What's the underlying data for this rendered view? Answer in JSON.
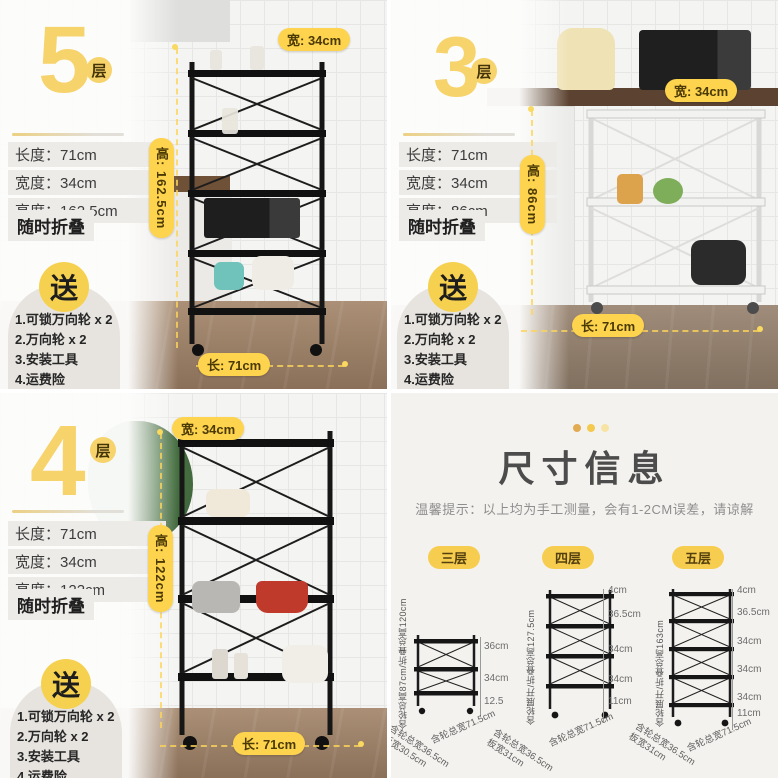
{
  "ui": {
    "colon": "：",
    "accent_yellow": "#f6d36b",
    "badge_yellow": "#fed44f",
    "tab_yellow": "#f6cd4e",
    "dot_colors": [
      "#e2ab52",
      "#f3c94e",
      "#f7e3a4"
    ],
    "panel_bg": "#f4f2ef",
    "text_dark": "#3c3c3c"
  },
  "panels": [
    {
      "tier_number": "5",
      "tier_unit": "层",
      "specs": [
        {
          "label": "长度",
          "value": "71cm"
        },
        {
          "label": "宽度",
          "value": "34cm"
        },
        {
          "label": "高度",
          "value": "162.5cm"
        }
      ],
      "fold_note": "随时折叠",
      "gift_badge": "送",
      "gifts": [
        "1.可锁万向轮 x 2",
        "2.万向轮 x 2",
        "3.安装工具",
        "4.运费险"
      ],
      "width_badge": "宽: 34cm",
      "height_badge": "高: 162.5cm",
      "length_badge": "长: 71cm"
    },
    {
      "tier_number": "3",
      "tier_unit": "层",
      "specs": [
        {
          "label": "长度",
          "value": "71cm"
        },
        {
          "label": "宽度",
          "value": "34cm"
        },
        {
          "label": "高度",
          "value": "86cm"
        }
      ],
      "fold_note": "随时折叠",
      "gift_badge": "送",
      "gifts": [
        "1.可锁万向轮 x 2",
        "2.万向轮 x 2",
        "3.安装工具",
        "4.运费险"
      ],
      "width_badge": "宽: 34cm",
      "height_badge": "高: 86cm",
      "length_badge": "长: 71cm"
    },
    {
      "tier_number": "4",
      "tier_unit": "层",
      "specs": [
        {
          "label": "长度",
          "value": "71cm"
        },
        {
          "label": "宽度",
          "value": "34cm"
        },
        {
          "label": "高度",
          "value": "122cm"
        }
      ],
      "fold_note": "随时折叠",
      "gift_badge": "送",
      "gifts": [
        "1.可锁万向轮 x 2",
        "2.万向轮 x 2",
        "3.安装工具",
        "4.运费险"
      ],
      "width_badge": "宽: 34cm",
      "height_badge": "高: 122cm",
      "length_badge": "长: 71cm"
    }
  ],
  "size_info": {
    "title": "尺寸信息",
    "tip": "温馨提示：以上均为手工测量，会有1-2CM误差，请谅解",
    "diagrams": [
      {
        "tab": "三层",
        "tiers": 3,
        "height_label": "含轮总高87cm/折叠总高120cm",
        "segments": [
          "36cm",
          "34cm",
          "12.5"
        ],
        "width_label": "含轮总宽71.5cm",
        "depth_label": "含轮总宽36.5cm",
        "board_label": "板宽30.5cm"
      },
      {
        "tab": "四层",
        "tiers": 4,
        "height_label": "含轮展开/折叠总高127.5cm",
        "segments": [
          "4cm",
          "36.5cm",
          "34cm",
          "34cm",
          "11cm"
        ],
        "width_label": "含轮总宽71.5cm",
        "depth_label": "含轮总宽36.5cm",
        "board_label": "板宽31cm"
      },
      {
        "tab": "五层",
        "tiers": 5,
        "height_label": "含轮展开/折叠总高163cm",
        "segments": [
          "4cm",
          "36.5cm",
          "34cm",
          "34cm",
          "34cm",
          "11cm"
        ],
        "width_label": "含轮总宽71.5cm",
        "depth_label": "含轮总宽36.5cm",
        "board_label": "板宽31cm"
      }
    ]
  }
}
